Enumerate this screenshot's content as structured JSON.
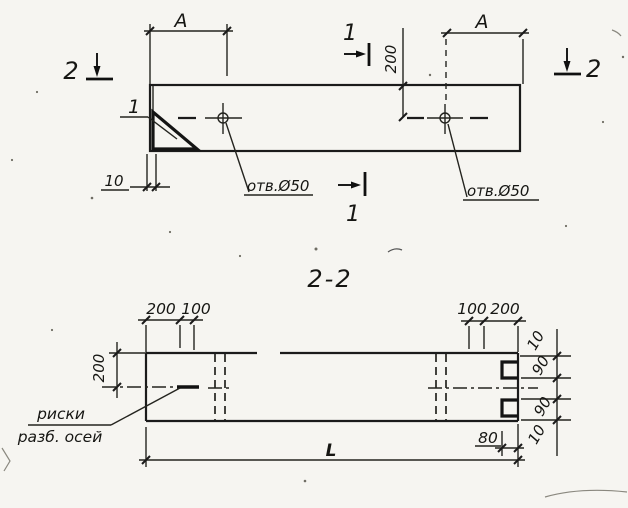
{
  "ink_color": "#1b1b1b",
  "background_color": "#f6f5f1",
  "plan_view": {
    "dim_a_left": "A",
    "dim_a_right": "A",
    "dim_hole_offset_200": "200",
    "dim_edge_10": "10",
    "detail_callout_1": "1",
    "hole_left_label": "отв.Ø50",
    "hole_right_label": "отв.Ø50",
    "section_cut_1_top": "1",
    "section_cut_1_bottom": "1",
    "section_cut_2_left": "2",
    "section_cut_2_right": "2"
  },
  "section_view": {
    "title": "2-2",
    "dims_top_left": [
      "200",
      "100"
    ],
    "dims_top_right": [
      "100",
      "200"
    ],
    "dim_height_200": "200",
    "axes_note_line1": "риски",
    "axes_note_line2": "разб. осей",
    "dim_length_L": "L",
    "dim_notch_depth_80": "80",
    "dims_right_chain": [
      "10",
      "90",
      "90",
      "10"
    ]
  }
}
